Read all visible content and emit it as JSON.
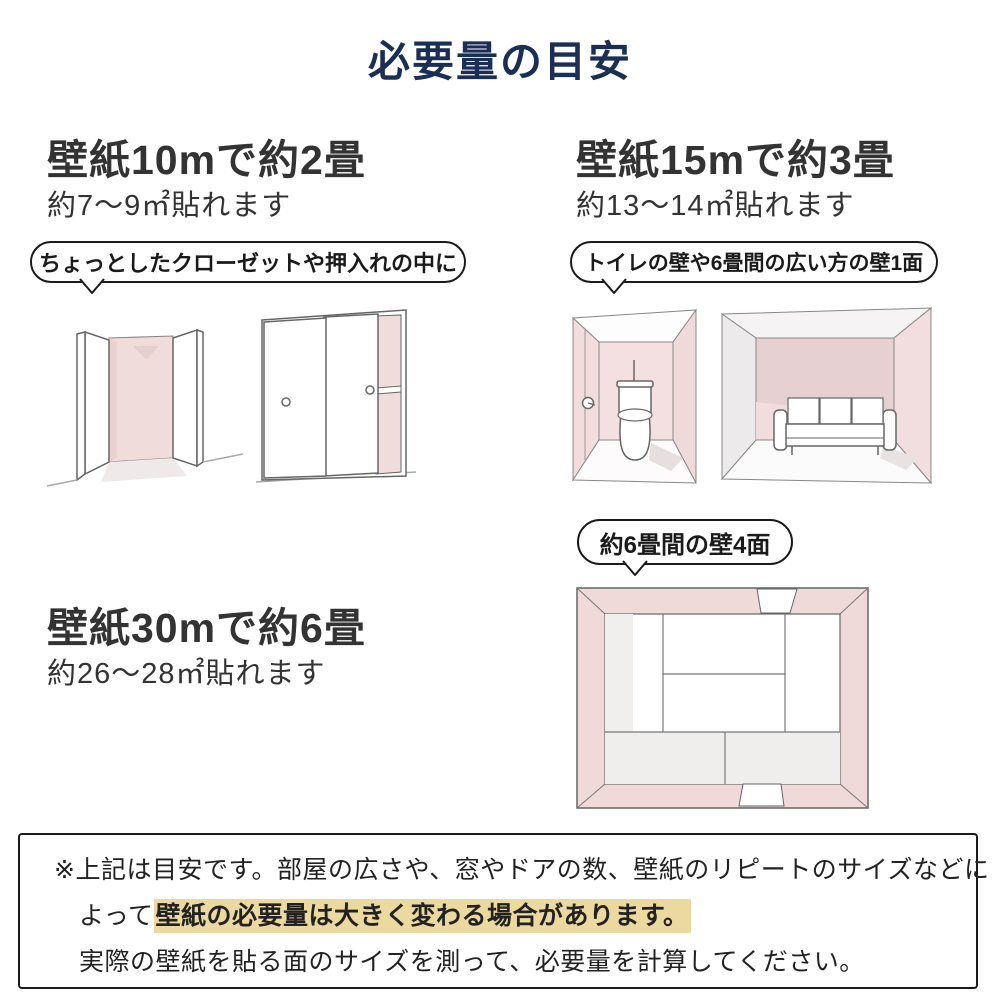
{
  "title": "必要量の目安",
  "colors": {
    "title_navy": "#1b2e55",
    "heading_gray": "#333333",
    "wall_pink": "#f1dcdc",
    "wall_pink_dark": "#e6d0d1",
    "highlight_tan": "#ecd9a0",
    "line_art_stroke": "#666666"
  },
  "sections": {
    "s10": {
      "heading": "壁紙10mで約2畳",
      "subtext": "約7〜9㎡貼れます",
      "bubble": "ちょっとしたクローゼットや押入れの中に"
    },
    "s15": {
      "heading": "壁紙15mで約3畳",
      "subtext": "約13〜14㎡貼れます",
      "bubble": "トイレの壁や6畳間の広い方の壁1面"
    },
    "s30": {
      "heading": "壁紙30mで約6畳",
      "subtext": "約26〜28㎡貼れます",
      "bubble": "約6畳間の壁4面"
    }
  },
  "note": {
    "line1": "※上記は目安です。部屋の広さや、窓やドアの数、壁紙のリピートのサイズなどに",
    "line2_prefix": "よって",
    "line2_highlight": "壁紙の必要量は大きく変わる場合があります。",
    "line3": "実際の壁紙を貼る面のサイズを測って、必要量を計算してください。"
  }
}
